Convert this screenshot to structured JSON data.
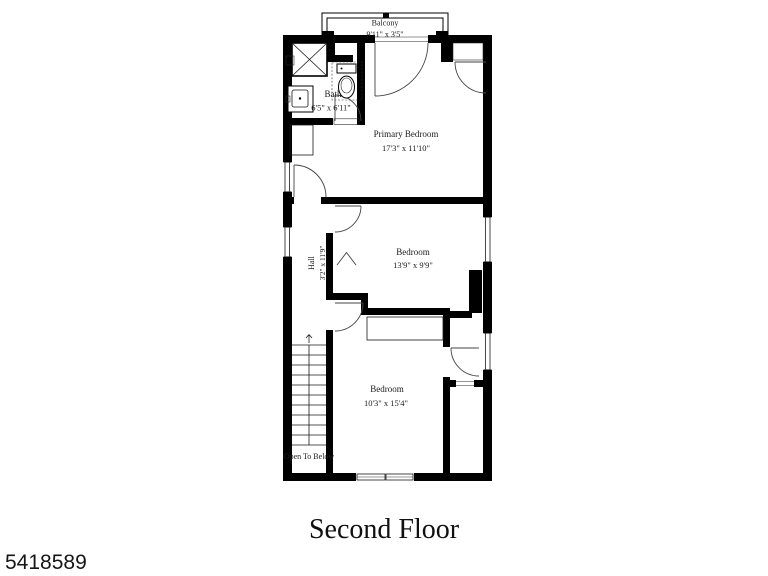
{
  "page": {
    "background_color": "#ffffff",
    "wall_color": "#000000",
    "text_color": "#1c1c1c"
  },
  "title": "Second Floor",
  "listing_id": "5418589",
  "floorplan": {
    "rooms": [
      {
        "name": "Balcony",
        "dims": "9'11\" x 3'5\""
      },
      {
        "name": "Bath",
        "dims": "6'5\" x 6'11\""
      },
      {
        "name": "Primary Bedroom",
        "dims": "17'3\" x 11'10\""
      },
      {
        "name": "Bedroom",
        "dims": "13'9\" x 9'9\""
      },
      {
        "name": "Bedroom",
        "dims": "10'3\" x 15'4\""
      },
      {
        "name": "Hall",
        "dims": "3'2\" x 11'9\""
      }
    ],
    "annotations": {
      "open_to_below": "Open To Below"
    },
    "features": [
      "staircase",
      "balcony",
      "shower",
      "toilet",
      "sink",
      "closets",
      "chimney"
    ]
  }
}
